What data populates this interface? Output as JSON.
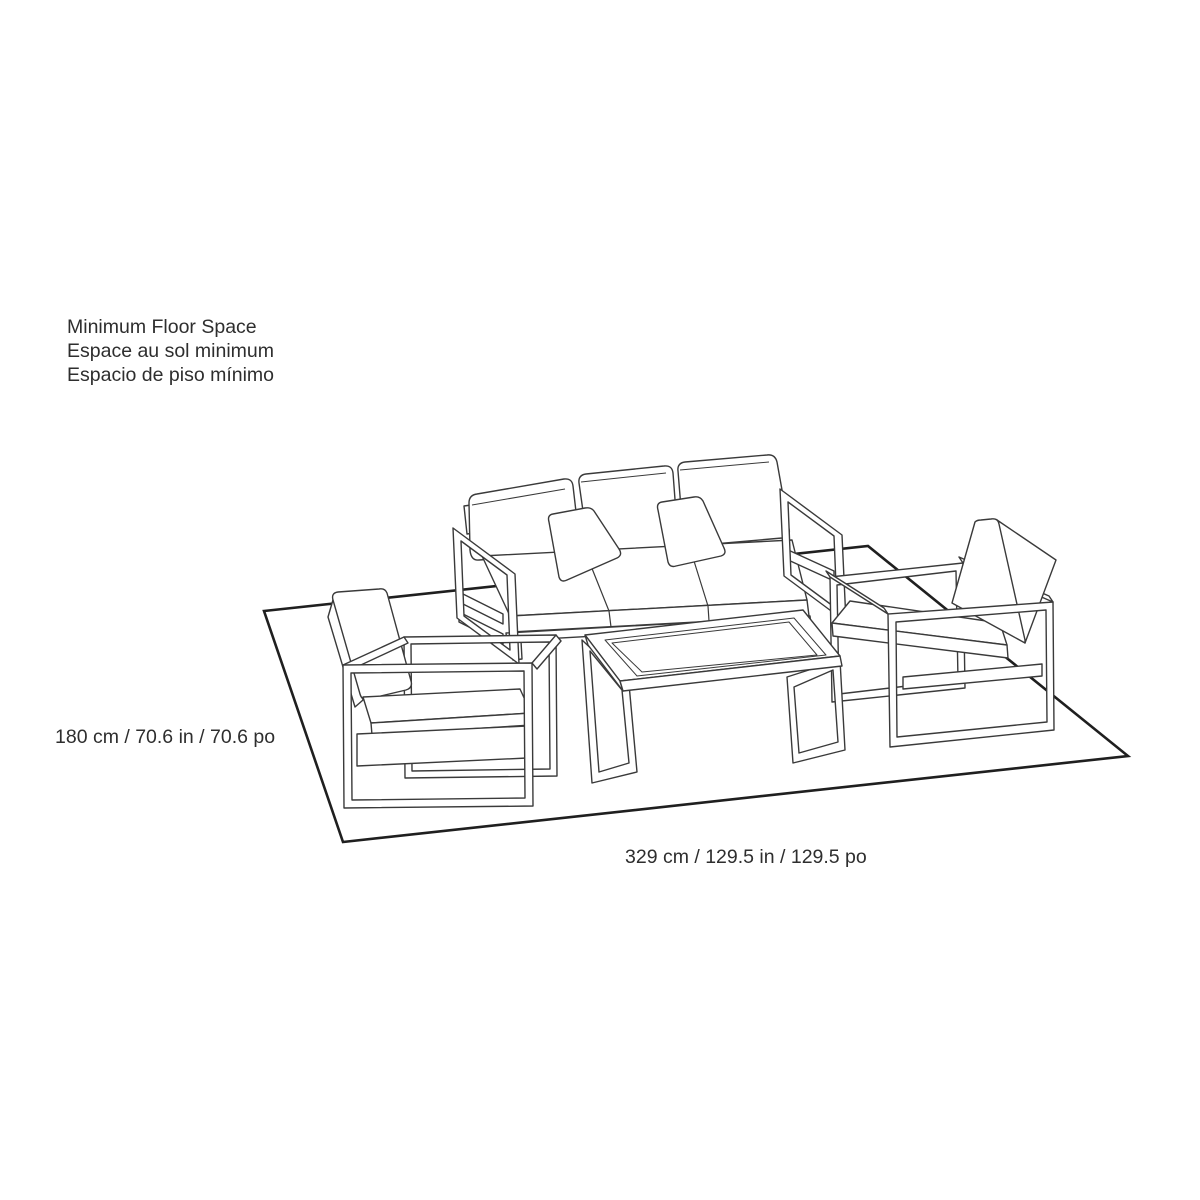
{
  "legend": {
    "lines": [
      "Minimum Floor Space",
      "Espace au sol minimum",
      "Espacio de piso mínimo"
    ]
  },
  "dimensions": {
    "depth": "180 cm / 70.6 in / 70.6 po",
    "width": "329 cm / 129.5 in / 129.5 po"
  },
  "colors": {
    "line": "#3a3a3a",
    "floor_line": "#1f1f1f",
    "text": "#2e2e2e",
    "background": "#ffffff"
  }
}
